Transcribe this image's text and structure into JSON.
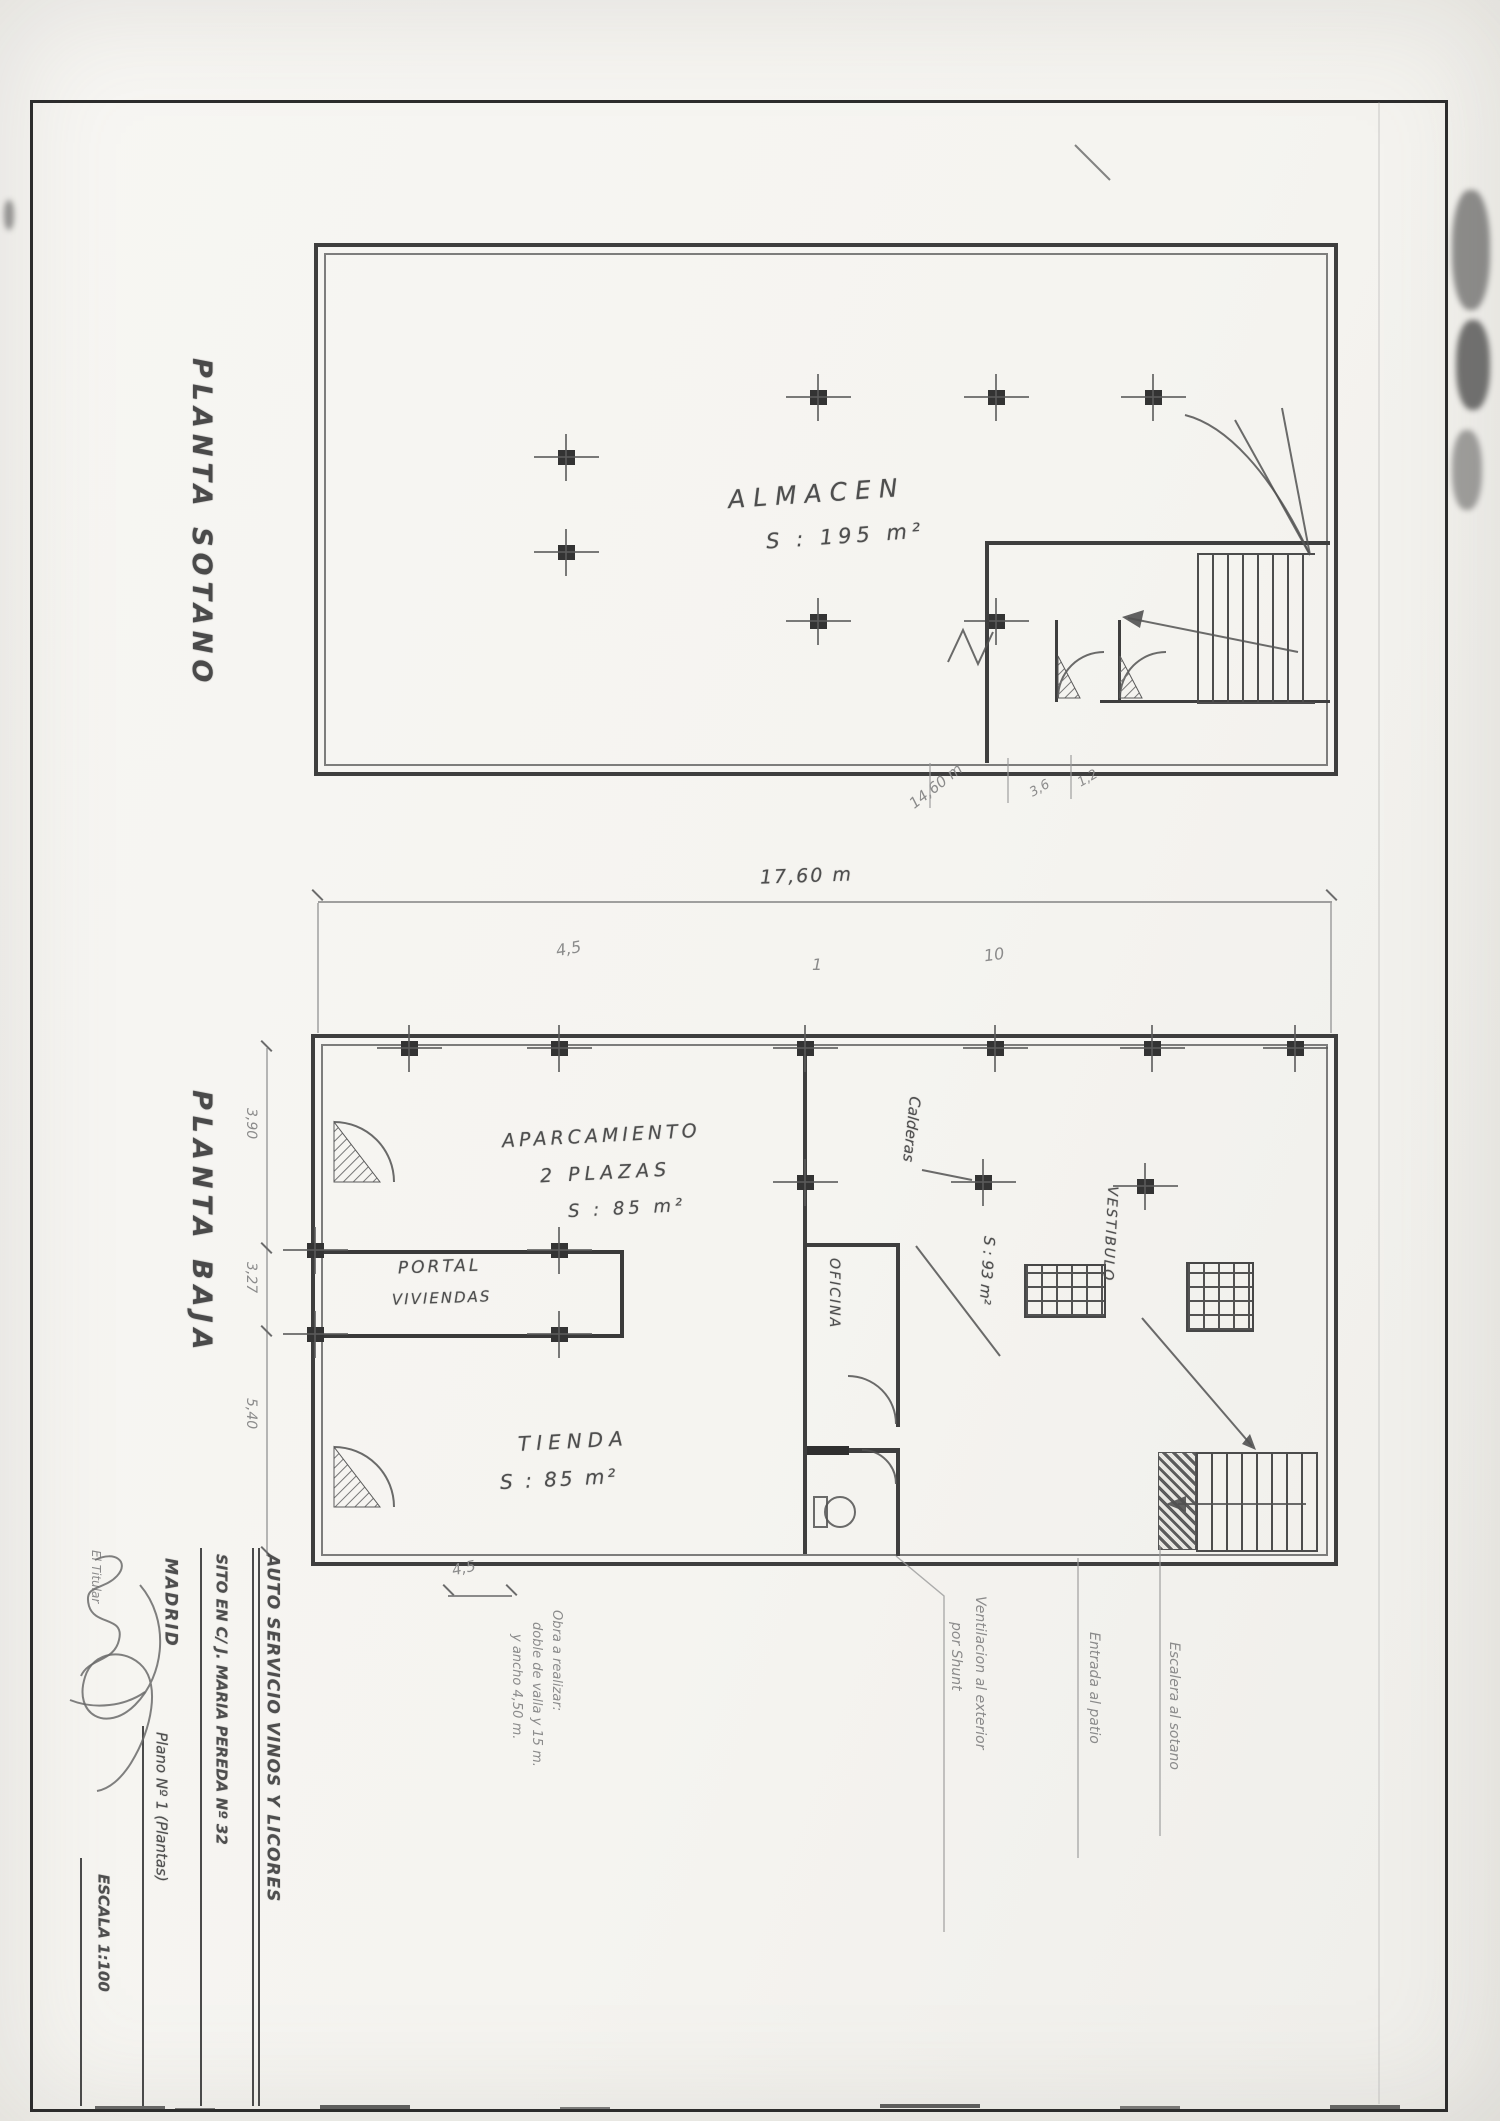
{
  "titles": {
    "sotano": "PLANTA SOTANO",
    "baja": "PLANTA BAJA"
  },
  "sotano": {
    "room": "ALMACEN",
    "area": "S : 195 m²",
    "dim_main": "14,60 m",
    "dim_a": "3,6",
    "dim_b": "1,2"
  },
  "baja": {
    "width_dim": "17,60 m",
    "mark_a": "4,5",
    "mark_b": "1",
    "mark_c": "10",
    "left_dim_a": "3,90",
    "left_dim_b": "3,27",
    "left_dim_c": "5,40",
    "bottom_dim": "4,5",
    "aparcamiento_l1": "APARCAMIENTO",
    "aparcamiento_l2": "2 PLAZAS",
    "aparcamiento_l3": "S : 85 m²",
    "portal_l1": "PORTAL",
    "portal_l2": "VIVIENDAS",
    "tienda_l1": "TIENDA",
    "tienda_l2": "S : 85 m²",
    "oficina": "OFICINA",
    "calderas": "Calderas",
    "calderas_area": "S : 93 m²",
    "vestibulo": "VESTIBULO"
  },
  "notes": {
    "obra_l1": "Obra a realizar:",
    "obra_l2": "doble de valla y 15 m.",
    "obra_l3": "y ancho 4,50 m.",
    "vent_l1": "Ventilacion al exterior",
    "vent_l2": "por Shunt",
    "entrada": "Entrada al patio",
    "escalera": "Escalera al sotano"
  },
  "titleblock": {
    "project": "AUTO SERVICIO VINOS Y LICORES",
    "address": "SITO EN C/ J. MARIA PEREDA Nº 32",
    "city": "MADRID",
    "sheet": "Plano Nº 1 (Plantas)",
    "scale": "ESCALA 1:100",
    "signer": "El Titular"
  }
}
